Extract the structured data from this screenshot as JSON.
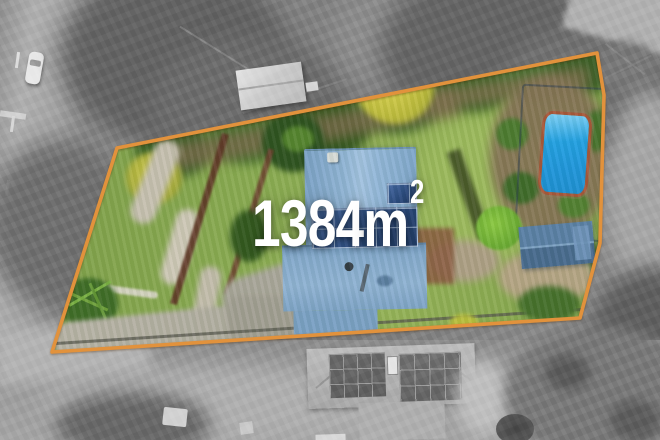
{
  "overlay": {
    "area_value": "1384",
    "area_unit": "m",
    "area_superscript": "2"
  },
  "colors": {
    "boundary": "#E2923C",
    "label": "#FFFFFF",
    "pool": "#22A0E2",
    "roof": "#8FB3D4",
    "lawn": "#86A64F"
  }
}
